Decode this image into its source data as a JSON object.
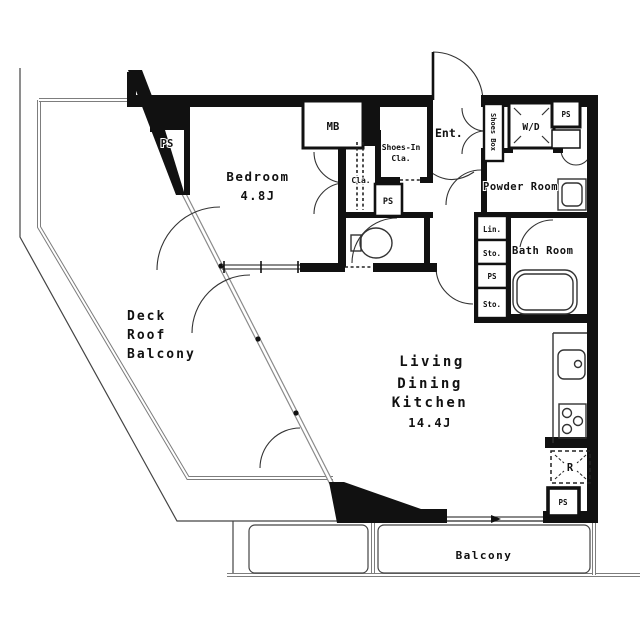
{
  "plan": {
    "rooms": {
      "bedroom": {
        "name": "Bedroom",
        "size": "4.8J"
      },
      "ldk": {
        "line1": "Living",
        "line2": "Dining",
        "line3": "Kitchen",
        "size": "14.4J"
      },
      "deck_roof_balcony": {
        "line1": "Deck",
        "line2": "Roof",
        "line3": "Balcony"
      },
      "entrance": {
        "name": "Ent."
      },
      "powder_room": {
        "name": "Powder Room"
      },
      "bath_room": {
        "name": "Bath Room"
      },
      "balcony": {
        "name": "Balcony"
      }
    },
    "storage": {
      "shoes_in_closet": {
        "line1": "Shoes-In",
        "line2": "Cla."
      },
      "closet": {
        "name": "Cla."
      },
      "linen": {
        "name": "Lin."
      },
      "storage_upper": {
        "name": "Sto."
      },
      "storage_lower": {
        "name": "Sto."
      },
      "shoes_box": {
        "name": "Shoes Box"
      }
    },
    "equipment": {
      "meter_box": "MB",
      "washer_dryer": "W/D",
      "refrigerator": "R"
    },
    "pipe_shafts": {
      "bedroom_side": "PS",
      "hall_side": "PS",
      "top_right": "PS",
      "service_column": "PS",
      "kitchen_side": "PS"
    },
    "colors": {
      "wall": "#111111",
      "line": "#444444",
      "railing": "#808080",
      "background": "#ffffff"
    }
  }
}
